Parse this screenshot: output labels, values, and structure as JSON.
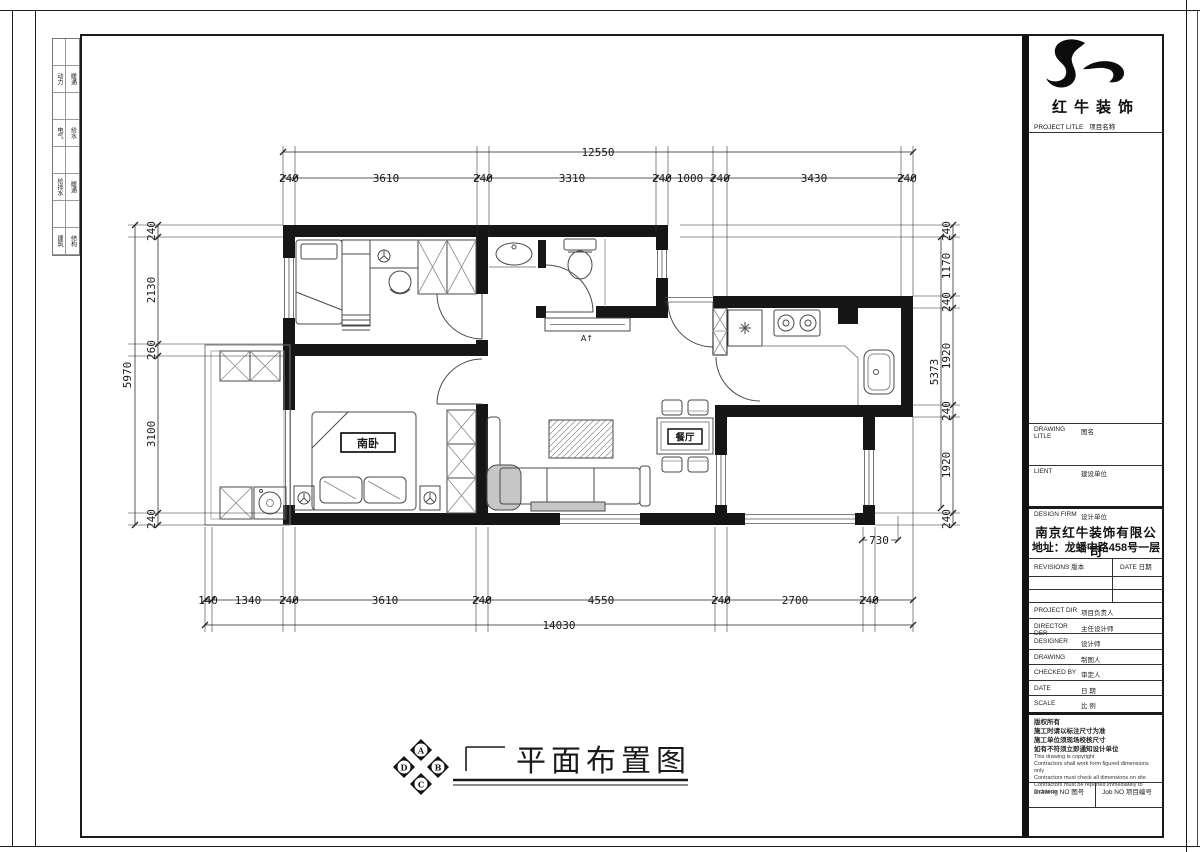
{
  "brand": {
    "name": "红牛装饰",
    "project_title_en": "PROJECT LITLE",
    "project_title_cn": "项目名称"
  },
  "titleblock": {
    "drawing_title": {
      "en": "DRAWING LITLE",
      "cn": "图名"
    },
    "client": {
      "en": "LIENT",
      "cn": "建设单位"
    },
    "design_firm": {
      "en": "DESIGN FIRM",
      "cn": "设计单位"
    },
    "company": "南京红牛装饰有限公司",
    "address": "地址：龙蟠中路458号一层",
    "revisions": {
      "en": "REVISIONS",
      "cn": "版本"
    },
    "date_col": {
      "en": "DATE",
      "cn": "日期"
    },
    "project_dir": {
      "en": "PROJECT DIR",
      "cn": "项目负责人"
    },
    "director": {
      "en": "DIRECTOR DER",
      "cn": "主任设计师"
    },
    "designer": {
      "en": "DESIGNER",
      "cn": "设计师"
    },
    "drawing": {
      "en": "DRAWING",
      "cn": "制图人"
    },
    "checked": {
      "en": "CHECKED BY",
      "cn": "审定人"
    },
    "date": {
      "en": "DATE",
      "cn": "日 期"
    },
    "scale": {
      "en": "SCALE",
      "cn": "比 例"
    },
    "copyright": [
      "版权所有",
      "施工时请以标注尺寸为准",
      "施工单位须现场校核尺寸",
      "如有不符须立即通知设计单位",
      "This drawing is copyright",
      "Contractors shall work form figured dimensions only",
      "Contractors must check all dimensions on site",
      "Contractors must be reported immediately to architects"
    ],
    "drawing_no": {
      "en": "Drawing NO",
      "cn": "图号"
    },
    "job_no": {
      "en": "Job NO",
      "cn": "项目编号"
    }
  },
  "strip": {
    "rows": [
      [
        "动力",
        "暖通"
      ],
      [
        "电气",
        "给水"
      ],
      [
        "给排水",
        "暖通"
      ],
      [
        "建筑",
        "结构"
      ]
    ]
  },
  "plan": {
    "rooms": {
      "south_bedroom": "南卧",
      "dining": "餐厅"
    },
    "marks": {
      "section": "A↑"
    }
  },
  "dims": {
    "top": {
      "overall": "12550",
      "segments": [
        "240",
        "3610",
        "240",
        "3310",
        "240",
        "1000",
        "240",
        "3430",
        "240"
      ]
    },
    "bottom": {
      "overall": "14030",
      "segments": [
        "140",
        "1340",
        "240",
        "3610",
        "240",
        "4550",
        "240",
        "2700",
        "240"
      ]
    },
    "left": {
      "overall": "5970",
      "segments": [
        "240",
        "2130",
        "260",
        "3100",
        "240"
      ]
    },
    "right": {
      "overall": "5373",
      "segments": [
        "240",
        "1170",
        "240",
        "1920",
        "240",
        "1920",
        "240"
      ]
    },
    "extra": "730"
  },
  "footer": {
    "title": "平面布置图",
    "compass": {
      "n": "A",
      "e": "B",
      "s": "C",
      "w": "D"
    }
  }
}
